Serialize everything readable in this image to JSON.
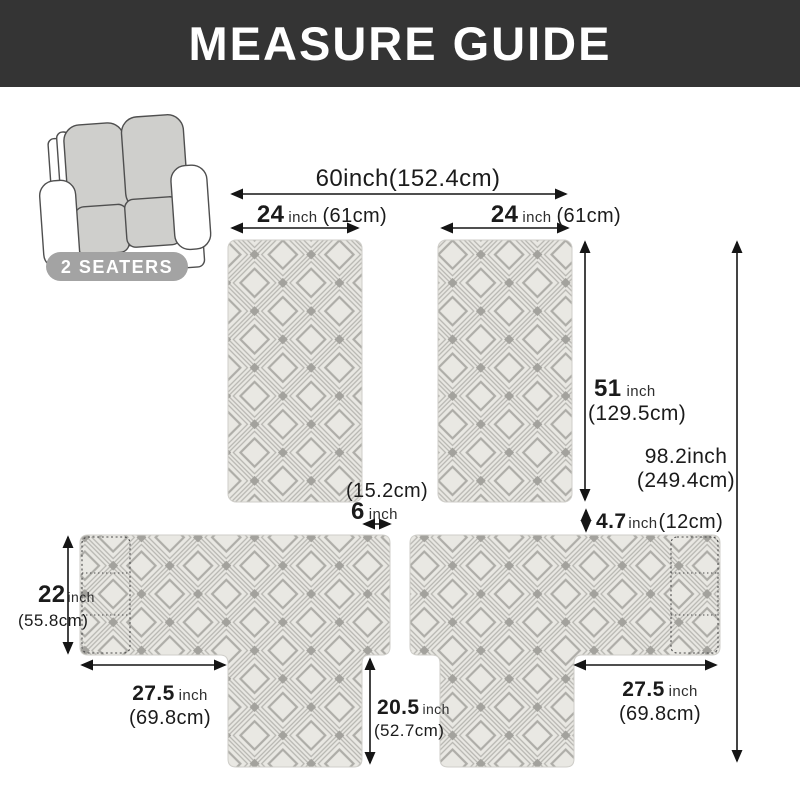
{
  "header": {
    "title": "MEASURE GUIDE"
  },
  "product": {
    "badge_label": "2 SEATERS",
    "icon": "loveseat-icon"
  },
  "dimensions": {
    "total_width": {
      "text": "60inch(152.4cm)"
    },
    "back_width_left": {
      "num": "24",
      "unit": "inch",
      "metric": "(61cm)"
    },
    "back_width_right": {
      "num": "24",
      "unit": "inch",
      "metric": "(61cm)"
    },
    "back_height": {
      "num": "51",
      "unit": "inch",
      "metric": "(129.5cm)"
    },
    "total_length": {
      "line1": "98.2inch",
      "line2": "(249.4cm)"
    },
    "gap": {
      "metric": "(15.2cm)",
      "num": "6",
      "unit": "inch"
    },
    "tuck": {
      "num": "4.7",
      "unit": "inch",
      "metric": "(12cm)"
    },
    "arm_height": {
      "num": "22",
      "unit": "inch",
      "metric": "(55.8cm)"
    },
    "arm_length_left": {
      "num": "27.5",
      "unit": "inch",
      "metric": "(69.8cm)"
    },
    "arm_length_right": {
      "num": "27.5",
      "unit": "inch",
      "metric": "(69.8cm)"
    },
    "front_height": {
      "num": "20.5",
      "unit": "inch",
      "metric": "(52.7cm)"
    }
  },
  "colors": {
    "header_bg": "#343434",
    "badge_bg": "#a3a3a3",
    "fabric_bg": "#e9e8e3",
    "fabric_line": "#b7b6b1",
    "fabric_dot": "#a3a29d",
    "annotation": "#1b1b1b"
  }
}
